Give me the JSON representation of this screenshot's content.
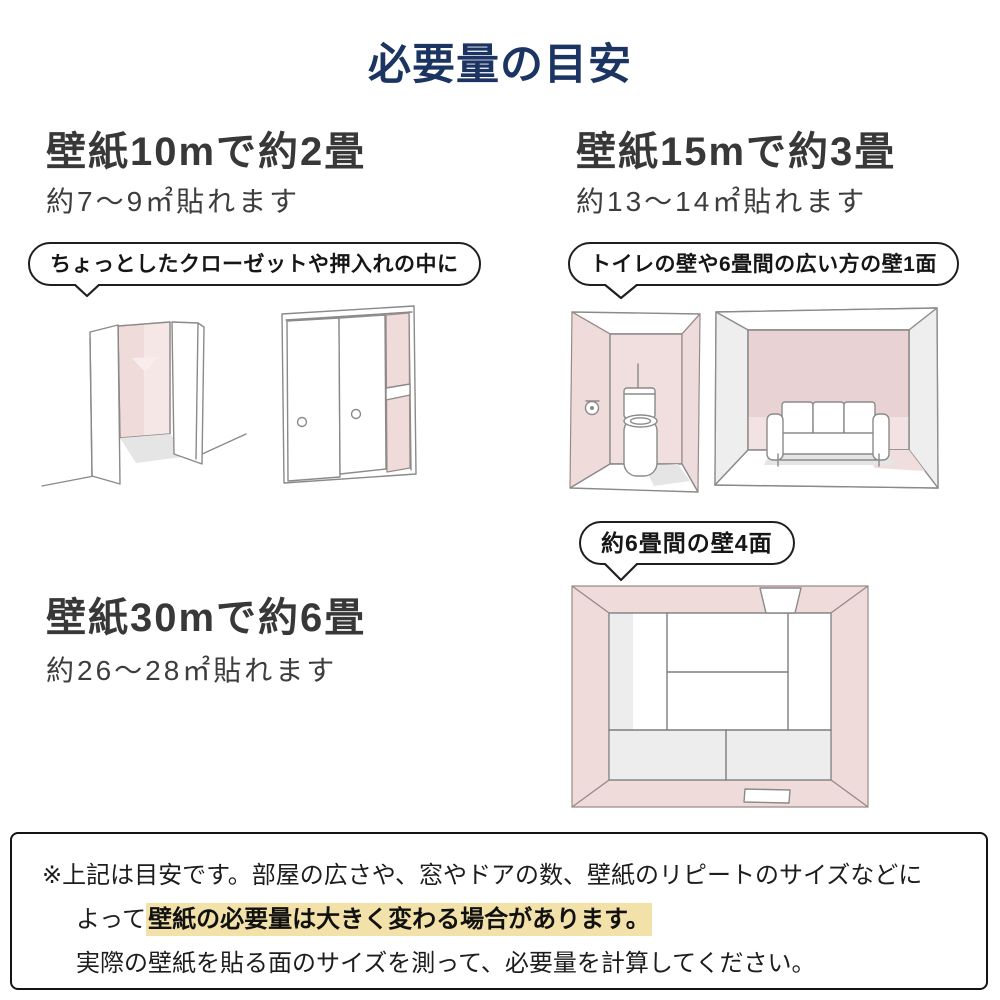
{
  "title": "必要量の目安",
  "colors": {
    "title_navy": "#1b3462",
    "heading_gray": "#383838",
    "wall_pink": "#f0dbdb",
    "back_wall_pink": "#e9d2d4",
    "highlight_yellow": "#f2e2a9",
    "note_border": "#141414"
  },
  "sections": [
    {
      "id": "wallpaper-10m",
      "heading": "壁紙10mで約2畳",
      "subtitle": "約7〜9㎡貼れます",
      "bubble": "ちょっとしたクローゼットや押入れの中に",
      "illustrations": [
        "open-closet-sketch",
        "sliding-closet-sketch"
      ]
    },
    {
      "id": "wallpaper-15m",
      "heading": "壁紙15mで約3畳",
      "subtitle": "約13〜14㎡貼れます",
      "bubble": "トイレの壁や6畳間の広い方の壁1面",
      "illustrations": [
        "toilet-room-sketch",
        "sofa-room-sketch"
      ]
    },
    {
      "id": "wallpaper-30m",
      "heading": "壁紙30mで約6畳",
      "subtitle": "約26〜28㎡貼れます",
      "bubble": "約6畳間の壁4面",
      "illustrations": [
        "tatami-room-top-view-sketch"
      ]
    }
  ],
  "note": {
    "line1": "※上記は目安です。部屋の広さや、窓やドアの数、壁紙のリピートのサイズなどに",
    "line2_prefix": "よって",
    "line2_highlight": "壁紙の必要量は大きく変わる場合があります。",
    "line3": "実際の壁紙を貼る面のサイズを測って、必要量を計算してください。"
  }
}
